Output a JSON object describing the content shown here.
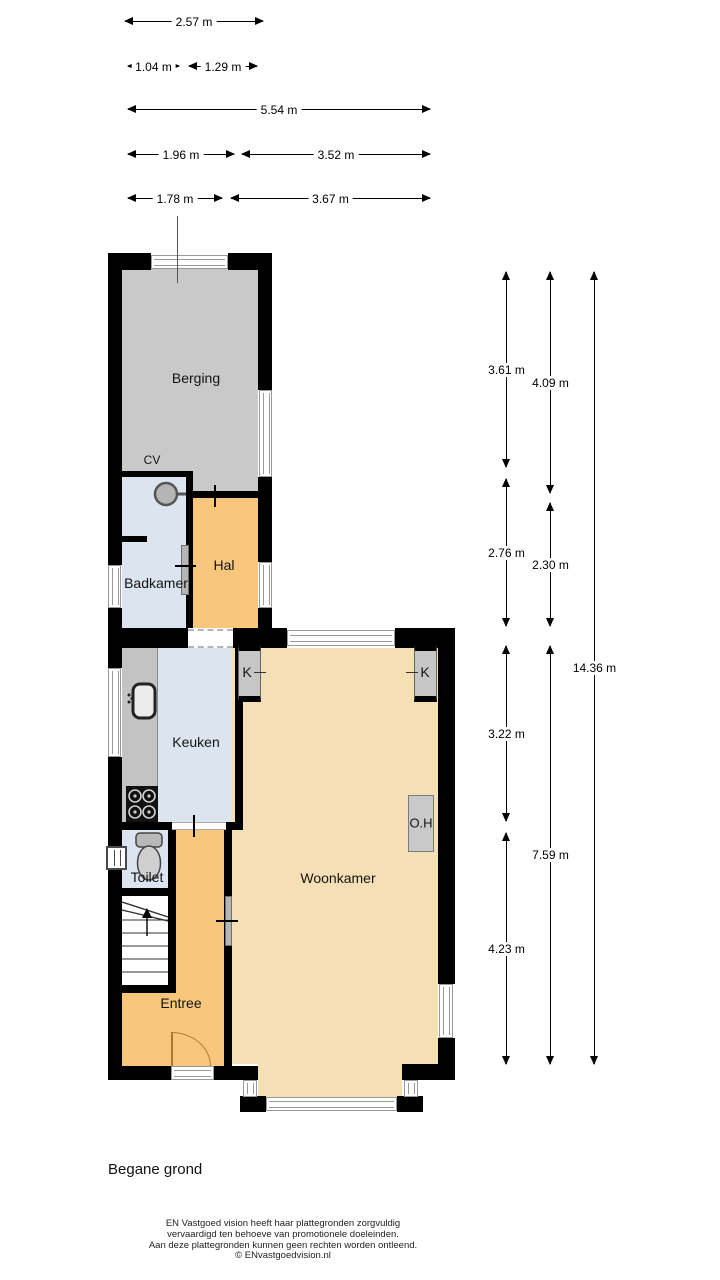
{
  "plan_title": "Begane grond",
  "rooms": {
    "berging": "Berging",
    "badkamer": "Badkamer",
    "hal": "Hal",
    "keuken": "Keuken",
    "toilet": "Toilet",
    "entree": "Entree",
    "woonkamer": "Woonkamer"
  },
  "annotations": {
    "cv": "CV",
    "kast_left": "K",
    "kast_right": "K",
    "fireplace": "O.H"
  },
  "dims": {
    "top": [
      "2.57 m",
      "1.04 m",
      "1.29 m",
      "5.54 m",
      "1.96 m",
      "3.52 m",
      "1.78 m",
      "3.67 m"
    ],
    "right_col1": [
      "3.61 m",
      "2.76 m",
      "3.22 m",
      "4.23 m"
    ],
    "right_col2": [
      "4.09 m",
      "2.30 m",
      "7.59 m"
    ],
    "right_col3": [
      "14.36 m"
    ]
  },
  "footer": [
    "EN Vastgoed vision heeft haar plattegronden zorgvuldig",
    "vervaardigd ten behoeve van promotionele doeleinden.",
    "Aan deze plattegronden kunnen geen rechten worden ontleend.",
    "© ENvastgoedvision.nl"
  ],
  "colors": {
    "wall": "#000000",
    "storage_room": "#c9c9c9",
    "wet_room": "#dbe4ef",
    "hall": "#f9c77c",
    "living_room": "#f5dfb5",
    "window_line": "#999999",
    "door_arc": "#a87b2f"
  }
}
